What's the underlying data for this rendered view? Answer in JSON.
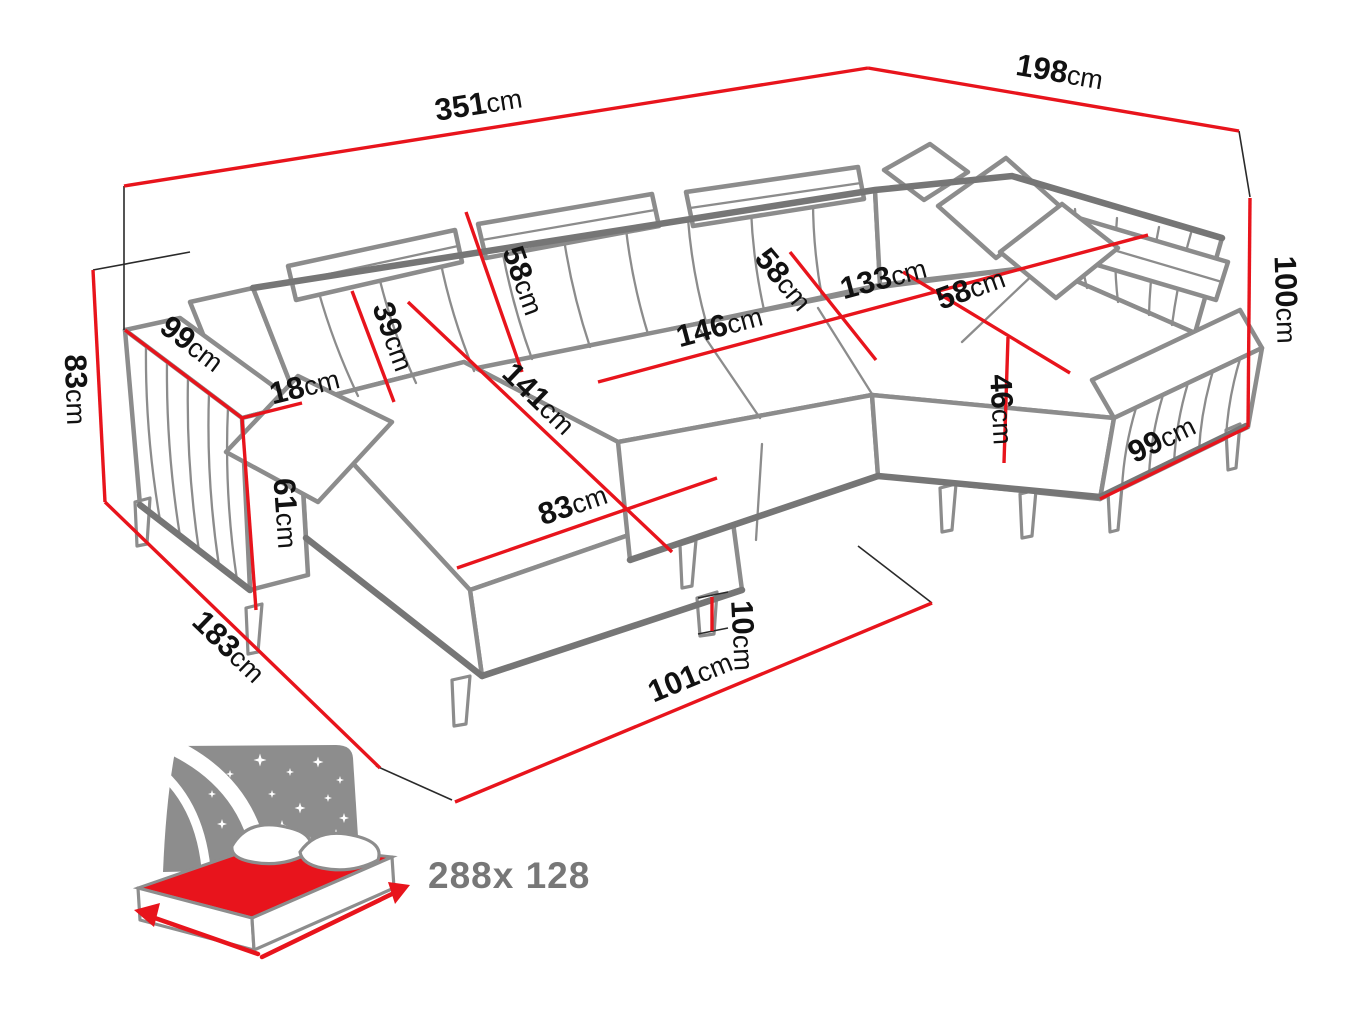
{
  "diagram_type": "sofa-dimension-drawing",
  "labels": [
    {
      "name": "total-width-back",
      "value": "351",
      "unit": "cm"
    },
    {
      "name": "total-depth-right",
      "value": "198",
      "unit": "cm"
    },
    {
      "name": "height-right",
      "value": "100",
      "unit": "cm"
    },
    {
      "name": "armrest-base-right",
      "value": "99",
      "unit": "cm"
    },
    {
      "name": "height-left",
      "value": "83",
      "unit": "cm"
    },
    {
      "name": "base-depth-left",
      "value": "183",
      "unit": "cm"
    },
    {
      "name": "base-width-front",
      "value": "101",
      "unit": "cm"
    },
    {
      "name": "armrest-length-left",
      "value": "99",
      "unit": "cm"
    },
    {
      "name": "armrest-width",
      "value": "18",
      "unit": "cm"
    },
    {
      "name": "armrest-front-height",
      "value": "61",
      "unit": "cm"
    },
    {
      "name": "backrest-height",
      "value": "39",
      "unit": "cm"
    },
    {
      "name": "headrest-width",
      "value": "58",
      "unit": "cm"
    },
    {
      "name": "chaise-length",
      "value": "141",
      "unit": "cm"
    },
    {
      "name": "chaise-width",
      "value": "83",
      "unit": "cm"
    },
    {
      "name": "seat-width-middle",
      "value": "146",
      "unit": "cm"
    },
    {
      "name": "seat-depth-middle",
      "value": "58",
      "unit": "cm"
    },
    {
      "name": "seat-width-right",
      "value": "133",
      "unit": "cm"
    },
    {
      "name": "seat-depth-right",
      "value": "58",
      "unit": "cm"
    },
    {
      "name": "seat-height",
      "value": "46",
      "unit": "cm"
    },
    {
      "name": "leg-height",
      "value": "10",
      "unit": "cm"
    }
  ],
  "sleeping_size": "288x 128",
  "colors": {
    "dimension": "#e8141c",
    "outline": "#8c8c8c",
    "outline_dark": "#767676",
    "thin_line": "#2a2a2a",
    "label_text": "#111111",
    "icon_gray": "#8d8d8d",
    "size_text": "#777777",
    "background": "#ffffff"
  }
}
